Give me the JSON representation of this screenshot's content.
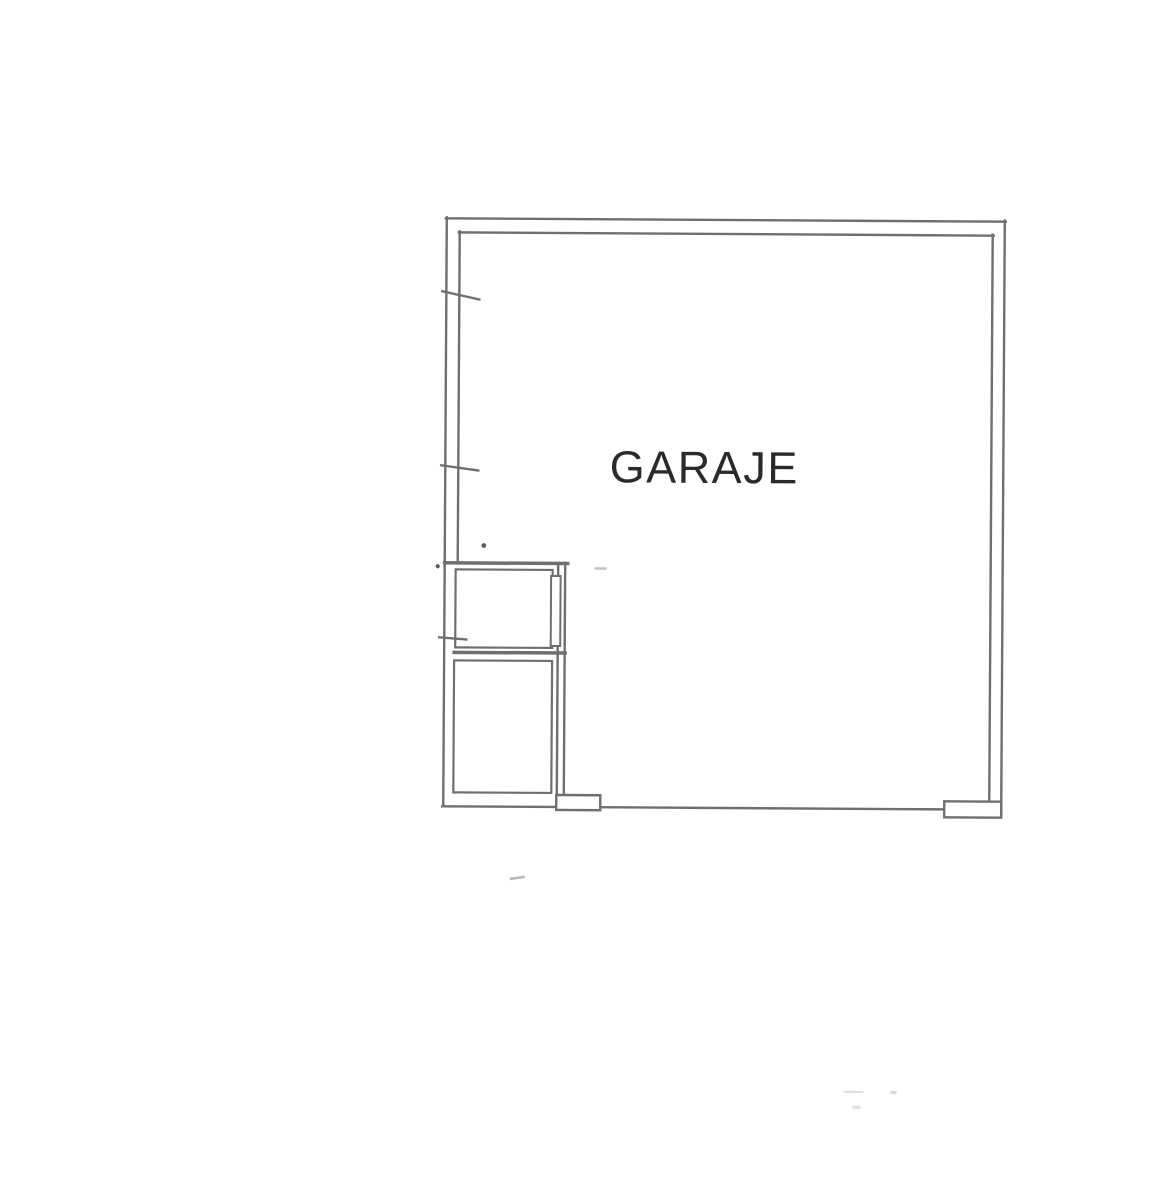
{
  "plan": {
    "room_label": "GARAJE"
  },
  "colors": {
    "paper": "#ffffff",
    "wall_line": "#6f6f6f",
    "label_text": "#2a2a2a",
    "speck_dark": "#5a5a5a",
    "speck_light": "#c2c2c2"
  }
}
